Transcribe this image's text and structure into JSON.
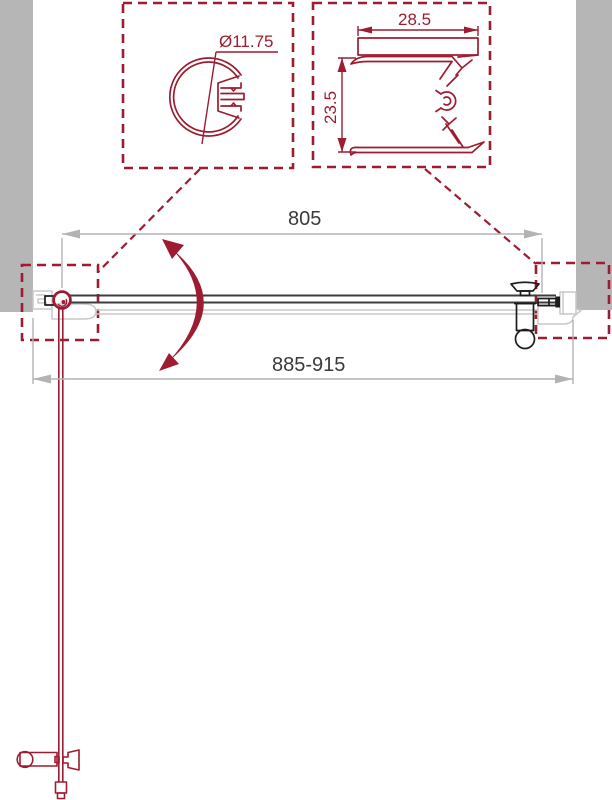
{
  "annotations": {
    "profile_diameter": "Ø11.75",
    "profile_width": "28.5",
    "profile_height": "23.5",
    "glass_width": "805",
    "overall_width": "885-915"
  },
  "colors": {
    "crimson": "#9e1c31",
    "wall-gray": "#b6b6b7",
    "outline-gray": "#c9c9c9",
    "dim-gray": "#b3b3b3",
    "dim-text": "#3a3a3a",
    "door-black": "#3d3d3d",
    "hardware-black": "#1d1d1d"
  }
}
